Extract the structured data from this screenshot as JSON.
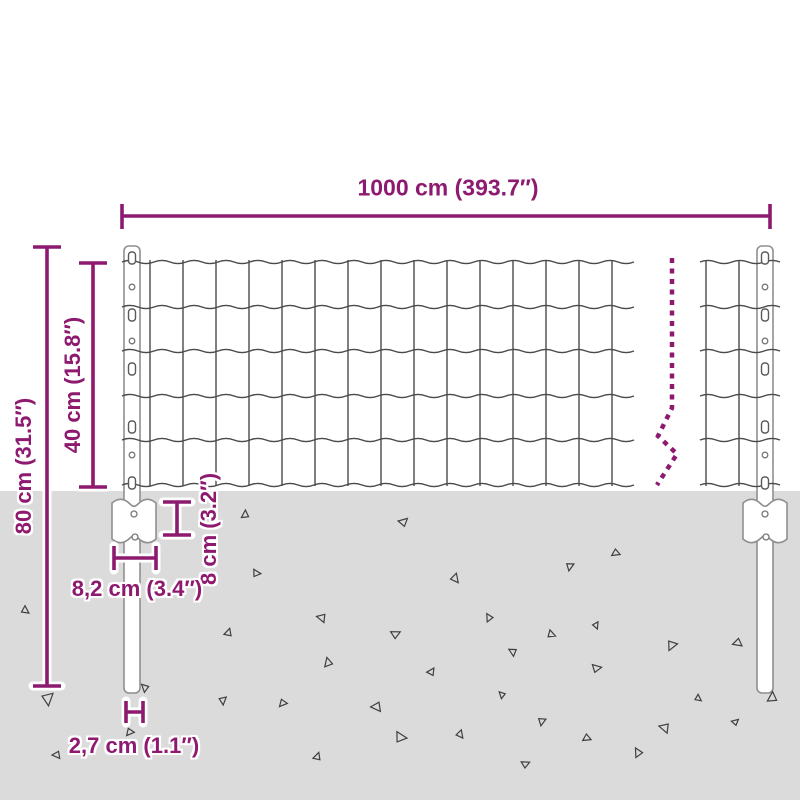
{
  "diagram": {
    "measurements": {
      "total_width": "1000 cm (393.7″)",
      "total_height": "80 cm (31.5″)",
      "mesh_height": "40 cm (15.8″)",
      "anchor_height": "8 cm (3.2″)",
      "anchor_width": "8,2 cm (3.4″)",
      "post_width": "2,7 cm (1.1″)"
    },
    "colors": {
      "accent": "#8E1A70",
      "ground": "#DBDBDB",
      "wire": "#4A4A4A",
      "outline": "#8F8F8F",
      "background": "#FFFFFF"
    }
  }
}
